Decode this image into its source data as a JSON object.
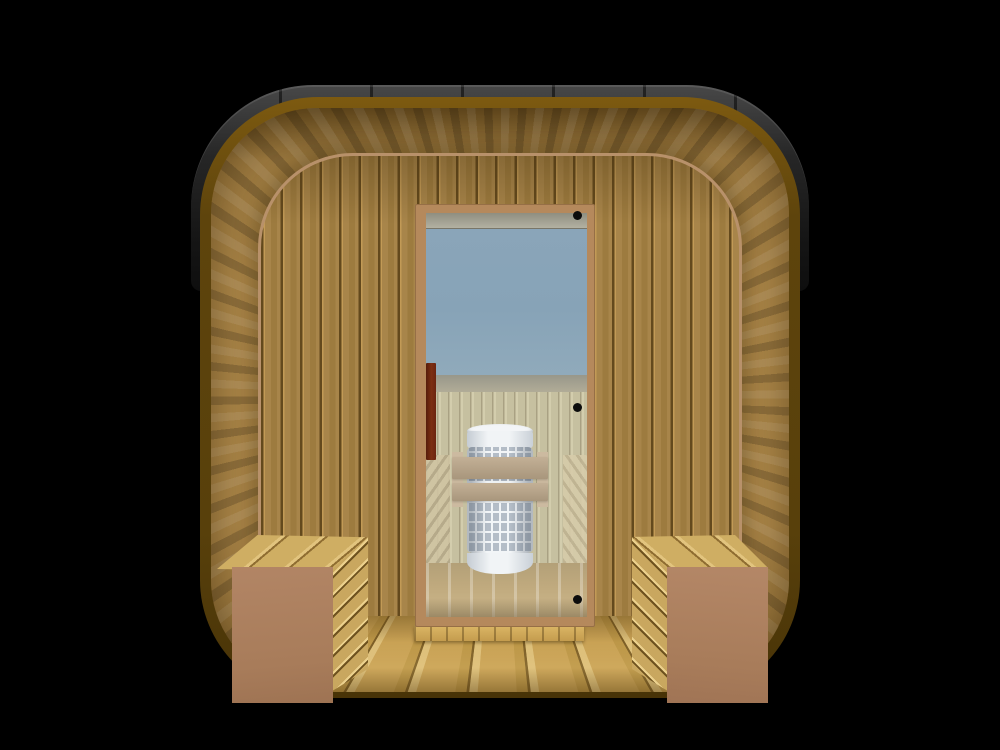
{
  "scene": {
    "title": "Cube sauna with full-glass door — front view 3D render",
    "view": "front elevation",
    "background": "black",
    "description": "Square barrel-style outdoor sauna with rounded corners: black roof band over a dark-bronze rim, wood-clad entrance reveal in perspective, vertical-slat facade, central glass door revealing a white mesh sauna heater with wooden guard rails, pale interior paneling, and two slatted porch benches flanking the doorway over a plank porch floor."
  },
  "objects": {
    "roof": {
      "label": "black roof band",
      "color": "#262626"
    },
    "rim": {
      "label": "outer bronze rim",
      "color": "#5e440c"
    },
    "reveal": {
      "label": "entrance reveal cladding",
      "color": "#ab8648"
    },
    "facade": {
      "label": "front wall, vertical tongue-and-groove slats",
      "color": "#a8854a"
    },
    "door": {
      "label": "full glass door",
      "frame_color": "#b5895c",
      "glass_color": "#87a3b7",
      "hinge_count": 3,
      "hinge_side": "right",
      "handle": {
        "label": "vertical pull handle",
        "color": "#7d2f12",
        "side": "left"
      }
    },
    "interior": {
      "wall_color": "#c6c0a0",
      "floor_color": "#c0aa7e",
      "heater": {
        "label": "cylindrical mesh sauna heater",
        "body_color": "#f1f4f6",
        "mesh_color": "#b4bdc7",
        "guard_rail_count": 2,
        "guard_rail_color": "#a8967c"
      },
      "side_benches": 2
    },
    "porch": {
      "floor_label": "plank porch floor",
      "floor_color": "#c9a255",
      "threshold_color": "#dcb766",
      "benches": [
        {
          "position": "left",
          "top_color": "#cfae63",
          "front_color": "#a87c5a",
          "slat_color": "#c9a75f"
        },
        {
          "position": "right",
          "top_color": "#cfae63",
          "front_color": "#a87c5a",
          "slat_color": "#c9a75f"
        }
      ]
    }
  },
  "counts": {
    "door_hinges": 3,
    "heater_guard_rails": 2,
    "porch_benches": 2,
    "interior_benches": 2
  },
  "colors": {
    "bg": "#000000",
    "roof": "#262626",
    "frame": "#5e440c",
    "frame_hi": "#7d5a10",
    "reveal": "#ab8648",
    "facade": "#a8854a",
    "facade_groove": "#63491d",
    "facade_edge": "#b8916a",
    "door_frame": "#b5895c",
    "glass": "#87a3b7",
    "glass_ceiling": "#b3b1a2",
    "glass_band": "#b1ac97",
    "int_wall": "#c6c0a0",
    "int_wall_groove": "#a9a183",
    "int_floor": "#c0aa7e",
    "heater_white": "#f1f4f6",
    "heater_cell": "#b4bdc7",
    "rail": "#a8967c",
    "rail_post": "#ccbaa0",
    "handle": "#7d2f12",
    "hinge": "#0c0c0c",
    "bench_front": "#a87c5a",
    "bench_top": "#cfae63",
    "bench_seam": "#8f6d31",
    "bench_slat": "#c9a75f",
    "porch": "#c9a255",
    "porch_light": "#ddbf7a",
    "porch_seam": "#7d5f27",
    "threshold": "#dcb766"
  }
}
